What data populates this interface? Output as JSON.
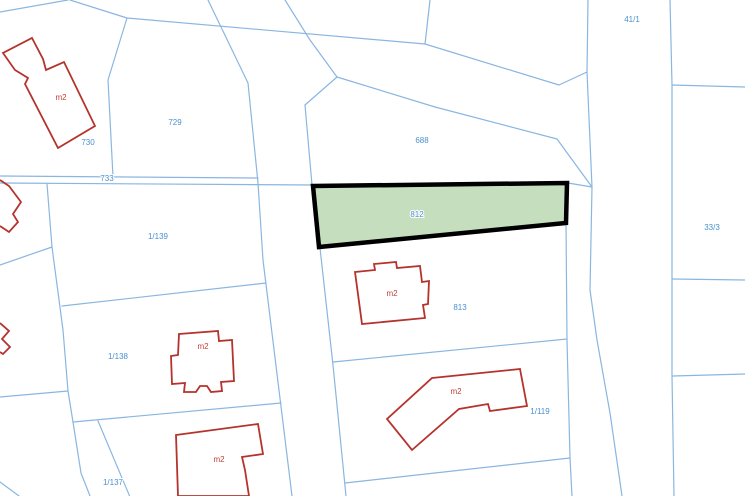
{
  "map": {
    "colors": {
      "background": "#ffffff",
      "boundary_line": "#8ab6e0",
      "building_outline": "#b5332d",
      "parcel_label": "#4a90d0",
      "building_label": "#c04038",
      "highlight_fill": "#c5dfbe",
      "highlight_stroke": "#000000"
    },
    "highlight": {
      "parcel_id": "812",
      "points": [
        [
          313,
          186
        ],
        [
          567,
          183
        ],
        [
          566,
          223
        ],
        [
          319,
          247
        ]
      ]
    },
    "boundaries": [
      {
        "points": [
          [
            0,
            12
          ],
          [
            68,
            0
          ]
        ]
      },
      {
        "points": [
          [
            70,
            0
          ],
          [
            127,
            18
          ],
          [
            425,
            44
          ],
          [
            559,
            85
          ],
          [
            587,
            72
          ]
        ]
      },
      {
        "points": [
          [
            430,
            0
          ],
          [
            425,
            44
          ]
        ]
      },
      {
        "points": [
          [
            127,
            18
          ],
          [
            108,
            80
          ],
          [
            113,
            177
          ]
        ]
      },
      {
        "points": [
          [
            208,
            0
          ],
          [
            248,
            83
          ],
          [
            258,
            183
          ],
          [
            263,
            260
          ],
          [
            292,
            496
          ]
        ]
      },
      {
        "points": [
          [
            305,
            105
          ],
          [
            312,
            185
          ],
          [
            320,
            248
          ],
          [
            333,
            365
          ],
          [
            346,
            496
          ]
        ]
      },
      {
        "points": [
          [
            337,
            77
          ],
          [
            305,
            105
          ]
        ]
      },
      {
        "points": [
          [
            285,
            0
          ],
          [
            310,
            40
          ],
          [
            337,
            77
          ]
        ]
      },
      {
        "points": [
          [
            337,
            77
          ],
          [
            435,
            107
          ],
          [
            557,
            139
          ]
        ]
      },
      {
        "points": [
          [
            557,
            139
          ],
          [
            592,
            187
          ]
        ]
      },
      {
        "points": [
          [
            568,
            183
          ],
          [
            592,
            187
          ]
        ]
      },
      {
        "points": [
          [
            588,
            0
          ],
          [
            587,
            72
          ],
          [
            592,
            187
          ],
          [
            590,
            290
          ],
          [
            597,
            340
          ],
          [
            610,
            413
          ],
          [
            622,
            496
          ]
        ]
      },
      {
        "points": [
          [
            670,
            0
          ],
          [
            672,
            85
          ],
          [
            672,
            376
          ],
          [
            674,
            496
          ]
        ]
      },
      {
        "points": [
          [
            672,
            85
          ],
          [
            745,
            87
          ]
        ]
      },
      {
        "points": [
          [
            672,
            279
          ],
          [
            745,
            280
          ]
        ]
      },
      {
        "points": [
          [
            673,
            376
          ],
          [
            745,
            374
          ]
        ]
      },
      {
        "points": [
          [
            0,
            176
          ],
          [
            258,
            178
          ]
        ]
      },
      {
        "points": [
          [
            0,
            183
          ],
          [
            313,
            185
          ]
        ]
      },
      {
        "points": [
          [
            47,
            184
          ],
          [
            52,
            247
          ],
          [
            63,
            330
          ],
          [
            68,
            391
          ],
          [
            73,
            422
          ],
          [
            81,
            473
          ],
          [
            90,
            496
          ]
        ]
      },
      {
        "points": [
          [
            0,
            265
          ],
          [
            52,
            247
          ]
        ]
      },
      {
        "points": [
          [
            0,
            397
          ],
          [
            68,
            391
          ]
        ]
      },
      {
        "points": [
          [
            62,
            306
          ],
          [
            266,
            283
          ]
        ]
      },
      {
        "points": [
          [
            73,
            422
          ],
          [
            281,
            403
          ]
        ]
      },
      {
        "points": [
          [
            98,
            421
          ],
          [
            130,
            497
          ]
        ]
      },
      {
        "points": [
          [
            0,
            482
          ],
          [
            19,
            496
          ]
        ]
      },
      {
        "points": [
          [
            566,
            223
          ],
          [
            567,
            340
          ],
          [
            570,
            458
          ],
          [
            572,
            496
          ]
        ]
      },
      {
        "points": [
          [
            333,
            362
          ],
          [
            567,
            339
          ]
        ]
      },
      {
        "points": [
          [
            345,
            483
          ],
          [
            570,
            458
          ]
        ]
      }
    ],
    "buildings": [
      {
        "closed": true,
        "points": [
          [
            32,
            38
          ],
          [
            43,
            59
          ],
          [
            46,
            70
          ],
          [
            64,
            62
          ],
          [
            95,
            126
          ],
          [
            58,
            148
          ],
          [
            25,
            84
          ],
          [
            28,
            78
          ],
          [
            15,
            70
          ],
          [
            3,
            53
          ]
        ]
      },
      {
        "closed": false,
        "points": [
          [
            0,
            180
          ],
          [
            9,
            186
          ],
          [
            21,
            202
          ],
          [
            13,
            214
          ],
          [
            18,
            222
          ],
          [
            9,
            232
          ],
          [
            0,
            226
          ]
        ]
      },
      {
        "closed": false,
        "points": [
          [
            0,
            323
          ],
          [
            9,
            331
          ],
          [
            2,
            339
          ],
          [
            10,
            347
          ],
          [
            3,
            354
          ],
          [
            0,
            352
          ]
        ]
      },
      {
        "closed": true,
        "points": [
          [
            179,
            334
          ],
          [
            218,
            331
          ],
          [
            219,
            341
          ],
          [
            232,
            340
          ],
          [
            234,
            381
          ],
          [
            221,
            382
          ],
          [
            222,
            391
          ],
          [
            211,
            392
          ],
          [
            207,
            386
          ],
          [
            200,
            386
          ],
          [
            196,
            392
          ],
          [
            184,
            392
          ],
          [
            185,
            383
          ],
          [
            172,
            384
          ],
          [
            171,
            356
          ],
          [
            178,
            355
          ]
        ]
      },
      {
        "closed": true,
        "points": [
          [
            176,
            435
          ],
          [
            258,
            424
          ],
          [
            263,
            454
          ],
          [
            242,
            457
          ],
          [
            245,
            470
          ],
          [
            249,
            496
          ],
          [
            178,
            496
          ]
        ]
      },
      {
        "closed": true,
        "points": [
          [
            355,
            272
          ],
          [
            375,
            270
          ],
          [
            374,
            264
          ],
          [
            396,
            262
          ],
          [
            397,
            268
          ],
          [
            420,
            266
          ],
          [
            422,
            282
          ],
          [
            429,
            281
          ],
          [
            428,
            304
          ],
          [
            423,
            305
          ],
          [
            425,
            318
          ],
          [
            362,
            324
          ]
        ]
      },
      {
        "closed": true,
        "points": [
          [
            432,
            378
          ],
          [
            520,
            369
          ],
          [
            527,
            406
          ],
          [
            490,
            411
          ],
          [
            488,
            404
          ],
          [
            459,
            409
          ],
          [
            412,
            450
          ],
          [
            387,
            419
          ]
        ]
      }
    ],
    "labels": [
      {
        "text": "730",
        "x": 88,
        "y": 145,
        "type": "parcel"
      },
      {
        "text": "729",
        "x": 175,
        "y": 125,
        "type": "parcel"
      },
      {
        "text": "733",
        "x": 107,
        "y": 181,
        "type": "parcel"
      },
      {
        "text": "1/139",
        "x": 158,
        "y": 239,
        "type": "parcel"
      },
      {
        "text": "1/138",
        "x": 118,
        "y": 359,
        "type": "parcel"
      },
      {
        "text": "1/137",
        "x": 113,
        "y": 485,
        "type": "parcel"
      },
      {
        "text": "688",
        "x": 422,
        "y": 143,
        "type": "parcel"
      },
      {
        "text": "812",
        "x": 417,
        "y": 217,
        "type": "parcel"
      },
      {
        "text": "813",
        "x": 460,
        "y": 310,
        "type": "parcel"
      },
      {
        "text": "1/119",
        "x": 540,
        "y": 414,
        "type": "parcel"
      },
      {
        "text": "41/1",
        "x": 632,
        "y": 22,
        "type": "parcel"
      },
      {
        "text": "33/3",
        "x": 712,
        "y": 230,
        "type": "parcel"
      },
      {
        "text": "m2",
        "x": 61,
        "y": 100,
        "type": "building"
      },
      {
        "text": "m2",
        "x": 203,
        "y": 349,
        "type": "building"
      },
      {
        "text": "m2",
        "x": 219,
        "y": 462,
        "type": "building"
      },
      {
        "text": "m2",
        "x": 392,
        "y": 296,
        "type": "building"
      },
      {
        "text": "m2",
        "x": 456,
        "y": 394,
        "type": "building"
      }
    ]
  }
}
